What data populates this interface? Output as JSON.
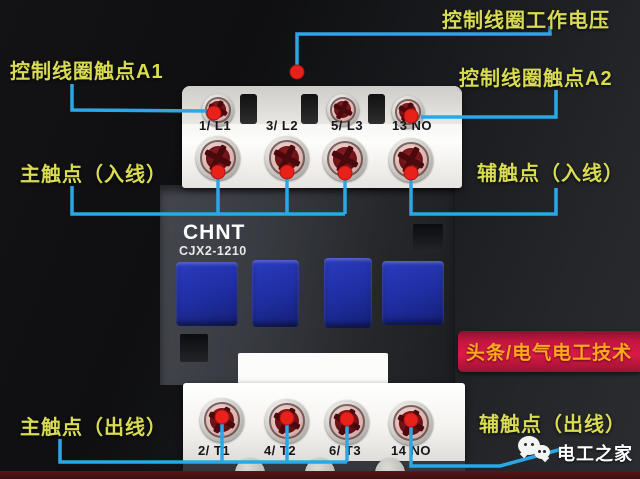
{
  "annotations": {
    "coil_voltage": "控制线圈工作电压",
    "coil_a1": "控制线圈触点A1",
    "coil_a2": "控制线圈触点A2",
    "main_in": "主触点（入线）",
    "aux_in": "辅触点（入线）",
    "main_out": "主触点（出线）",
    "aux_out": "辅触点（出线）"
  },
  "device": {
    "brand": "CHNT",
    "model": "CJX2-1210",
    "terminals_top": [
      "1/ L1",
      "3/ L2",
      "5/ L3",
      "13 NO"
    ],
    "terminals_bottom": [
      "2/ T1",
      "4/ T2",
      "6/ T3",
      "14 NO"
    ]
  },
  "watermarks": {
    "banner": "头条/电气电工技术",
    "wechat": "电工之家"
  },
  "icons": {
    "wechat": "wechat-chat-bubbles-icon"
  },
  "colors": {
    "label_yellow": "#d9dc52",
    "line_blue": "#2ba7e8",
    "dot_red": "#e8211b",
    "banner_red": "#d91a47",
    "banner_text": "#ffa81e",
    "device_blue": "#1f2da0"
  }
}
